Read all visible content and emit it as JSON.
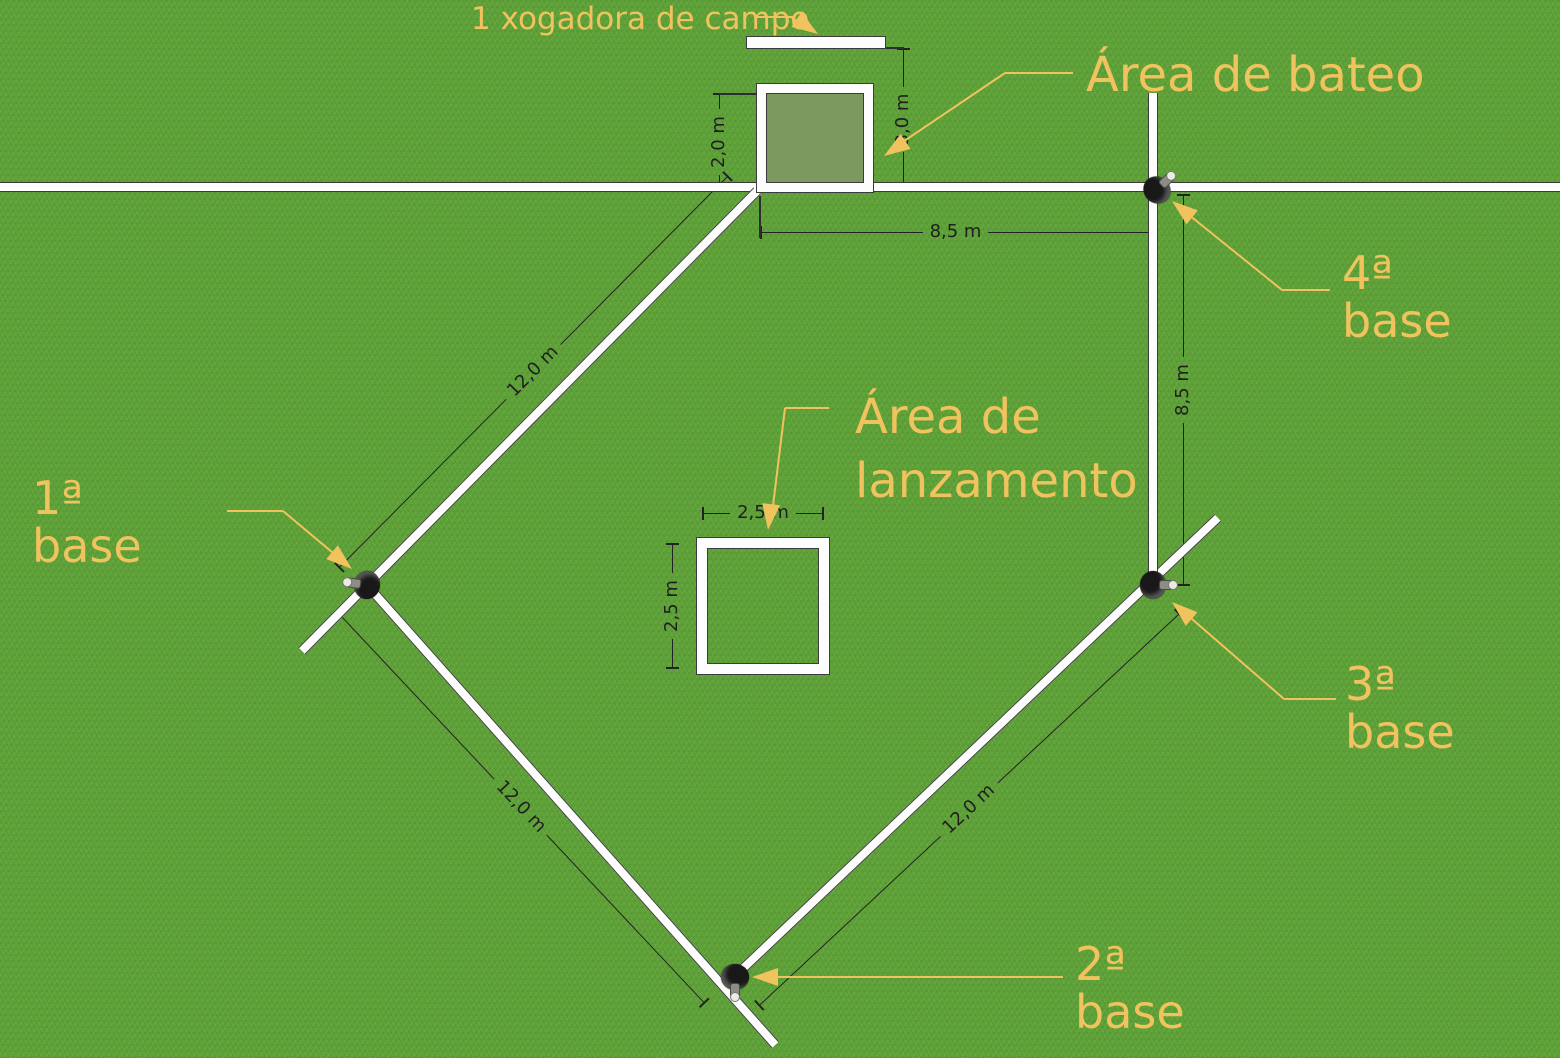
{
  "labels": {
    "fielder": "1 xogadora de campo",
    "batting_area": "Área de bateo",
    "pitching_area": {
      "line1": "Área de",
      "line2": "lanzamento"
    },
    "base1": "1ª base",
    "base2": "2ª base",
    "base3": "3ª base",
    "base4": "4ª base"
  },
  "dimensions": {
    "batting_square_side": "2,0 m",
    "bar_to_boundary": "3,0 m",
    "home_to_base4": "8,5 m",
    "base4_to_base3": "8,5 m",
    "pitch_square_width": "2,5 m",
    "pitch_square_height": "2,5 m",
    "side_home_base1": "12,0 m",
    "side_base1_base2": "12,0 m",
    "side_base2_base3": "12,0 m"
  },
  "colors": {
    "grass": "#5fa338",
    "field_line": "#fdfdfd",
    "line_edge": "#3b3b3b",
    "callout_label": "#f1c35f",
    "dimension_text": "#1f1f1f",
    "batting_square_fill": "#7c9a5f"
  }
}
